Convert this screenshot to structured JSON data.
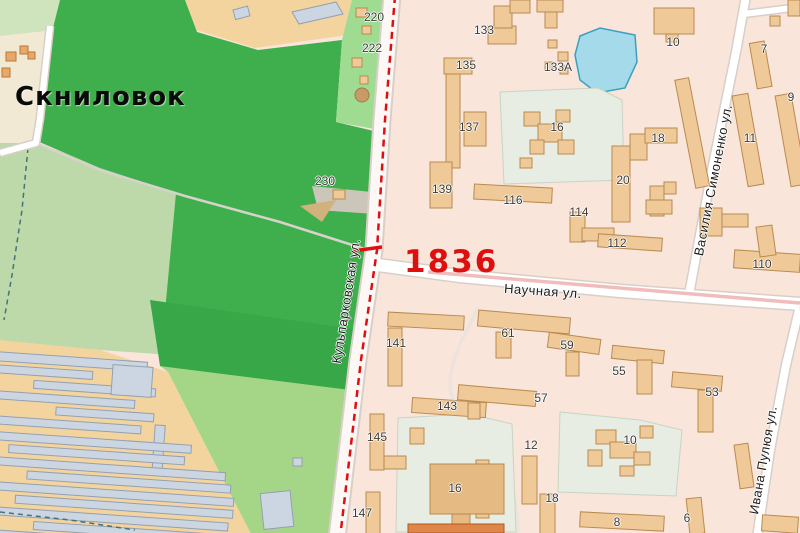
{
  "map": {
    "place_label": "Скниловок",
    "route_marker": {
      "label": "1836"
    },
    "street_labels": [
      {
        "text": "Научная ул.",
        "x": 543,
        "y": 291,
        "rot": 4
      },
      {
        "text": "Василия Симоненко ул.",
        "x": 713,
        "y": 180,
        "rot": -79
      },
      {
        "text": "Кульпарковская ул.",
        "x": 346,
        "y": 301,
        "rot": -81
      },
      {
        "text": "Ивана Пулюя ул.",
        "x": 763,
        "y": 460,
        "rot": -80
      }
    ],
    "building_labels": [
      {
        "text": "220",
        "x": 374,
        "y": 17
      },
      {
        "text": "222",
        "x": 372,
        "y": 48
      },
      {
        "text": "230",
        "x": 325,
        "y": 181
      },
      {
        "text": "133",
        "x": 484,
        "y": 30
      },
      {
        "text": "135",
        "x": 466,
        "y": 65
      },
      {
        "text": "133А",
        "x": 558,
        "y": 67
      },
      {
        "text": "137",
        "x": 469,
        "y": 127
      },
      {
        "text": "139",
        "x": 442,
        "y": 189
      },
      {
        "text": "16",
        "x": 557,
        "y": 127
      },
      {
        "text": "10",
        "x": 673,
        "y": 42
      },
      {
        "text": "7",
        "x": 764,
        "y": 49
      },
      {
        "text": "9",
        "x": 791,
        "y": 97
      },
      {
        "text": "18",
        "x": 658,
        "y": 138
      },
      {
        "text": "11",
        "x": 750,
        "y": 138
      },
      {
        "text": "20",
        "x": 623,
        "y": 180
      },
      {
        "text": "116",
        "x": 513,
        "y": 200
      },
      {
        "text": "114",
        "x": 579,
        "y": 212
      },
      {
        "text": "112",
        "x": 617,
        "y": 243
      },
      {
        "text": "110",
        "x": 762,
        "y": 264
      },
      {
        "text": "61",
        "x": 508,
        "y": 333
      },
      {
        "text": "59",
        "x": 567,
        "y": 345
      },
      {
        "text": "57",
        "x": 541,
        "y": 398
      },
      {
        "text": "55",
        "x": 619,
        "y": 371
      },
      {
        "text": "53",
        "x": 712,
        "y": 392
      },
      {
        "text": "12",
        "x": 531,
        "y": 445
      },
      {
        "text": "10",
        "x": 630,
        "y": 440
      },
      {
        "text": "141",
        "x": 396,
        "y": 343
      },
      {
        "text": "143",
        "x": 447,
        "y": 406
      },
      {
        "text": "145",
        "x": 377,
        "y": 437
      },
      {
        "text": "147",
        "x": 362,
        "y": 513
      },
      {
        "text": "16",
        "x": 455,
        "y": 488
      },
      {
        "text": "18",
        "x": 552,
        "y": 498
      },
      {
        "text": "8",
        "x": 617,
        "y": 522
      },
      {
        "text": "6",
        "x": 687,
        "y": 518
      }
    ],
    "colors": {
      "bg": "#f9e5da",
      "park": "#3fae4c",
      "parkdark": "#38a747",
      "field": "#bdd8a9",
      "fieldlight": "#cfe3bc",
      "greenstrip": "#9fdb90",
      "greenpatch": "#a5d687",
      "tan": "#f3d49f",
      "cream": "#f1e9d4",
      "water": "#a5daeb",
      "waterline": "#3aa0bc",
      "bldg": "#efc997",
      "bldgline": "#b98a50",
      "bldgdark": "#e5ba83",
      "plot": "#e7ede2",
      "plotline": "#c9d4c4",
      "ghouse": "#ccd6e3",
      "ghouseline": "#94a0b0",
      "road": "#fdf8f5",
      "roadline": "#d8cfc8",
      "tram": "#f2bcbc",
      "red": "#dd0f0f",
      "path": "#d7d2cb",
      "stream": "#45737a",
      "gravel": "#ccc5b9",
      "dirt": "#d2b27c",
      "hot": "#e08648"
    }
  }
}
